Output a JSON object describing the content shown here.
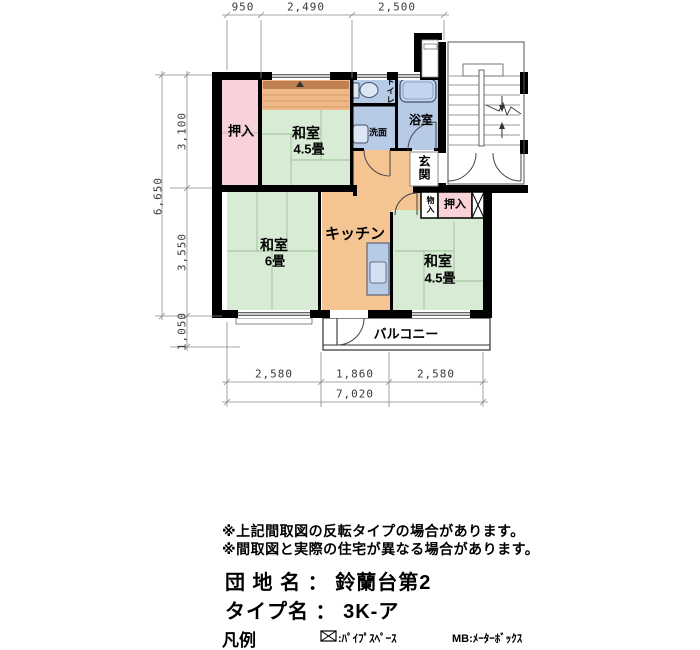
{
  "plan": {
    "dimensions": {
      "top": [
        "950",
        "2,490",
        "2,500"
      ],
      "left_total": "6,650",
      "left": [
        "3,100",
        "3,550",
        "1,050"
      ],
      "bottom": [
        "2,580",
        "1,860",
        "2,580"
      ],
      "bottom_total": "7,020"
    },
    "rooms": {
      "oshiire_top": "押入",
      "washitsu_a_name": "和室",
      "washitsu_a_size": "4.5畳",
      "toilet": "トイレ",
      "washroom": "洗面",
      "bath": "浴室",
      "genkan": "玄関",
      "storage": "物入",
      "oshiire_right": "押入",
      "washitsu_b_name": "和室",
      "washitsu_b_size": "6畳",
      "kitchen": "キッチン",
      "washitsu_c_name": "和室",
      "washitsu_c_size": "4.5畳",
      "balcony": "バルコニー"
    },
    "colors": {
      "tatami_green": "#d8ebd4",
      "closet_pink": "#f8d2d8",
      "wet_area_blue": "#b7cbe7",
      "hall_orange": "#f5c493",
      "wall_black": "#000000"
    }
  },
  "notes": [
    "※上記間取図の反転タイプの場合があります。",
    "※間取図と実際の住宅が異なる場合があります。"
  ],
  "info": {
    "line1": "団 地 名 ： 鈴蘭台第2",
    "line2": "タイプ名 ： 3K-ア"
  },
  "legend": {
    "title": "凡例",
    "ps": ":ﾊﾟｲﾌﾟｽﾍﾟｰｽ",
    "mb": "MB:ﾒｰﾀｰﾎﾞｯｸｽ"
  }
}
